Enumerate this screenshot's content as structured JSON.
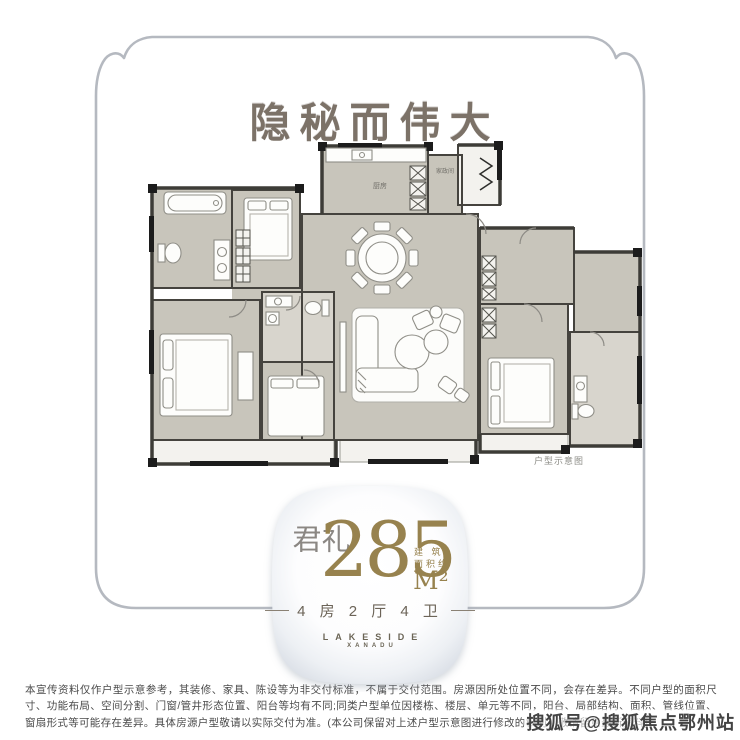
{
  "title": {
    "text": "隐秘而伟大"
  },
  "floor_plan": {
    "caption": "户型示意图",
    "labels": {
      "kitchen": "厨房",
      "utility": "家政间"
    }
  },
  "badge": {
    "name_vertical": "礼君",
    "area_value": "285",
    "area_unit": "M²",
    "area_note_line1": "建 筑",
    "area_note_line2": "面积约",
    "layout_text": "4 房 2 厅 4 卫",
    "brand_line1": "LAKESIDE",
    "brand_line2": "XANADU"
  },
  "disclaimer": {
    "text": "本宣传资料仅作户型示意参考，其装修、家具、陈设等为非交付标准，不属于交付范围。房源因所处位置不同，会存在差异。不同户型的面积尺寸、功能布局、空间分割、门窗/管井形态位置、阳台等均有不同;同类户型单位因楼栋、楼层、单元等不同，阳台、局部结构、面积、管线位置、窗扇形式等可能存在差异。具体房源户型敬请以实际交付为准。(本公司保留对上述户型示意图进行修改的权利，敬请留意最新资料)"
  },
  "watermark": {
    "text": "搜狐号@搜狐焦点鄂州站"
  },
  "colors": {
    "gold": "#97824e",
    "frame_line": "#b5b9c0",
    "wall": "#45433e",
    "floor_gray": "#c8c5bb",
    "title_gray": "#7c7268"
  }
}
